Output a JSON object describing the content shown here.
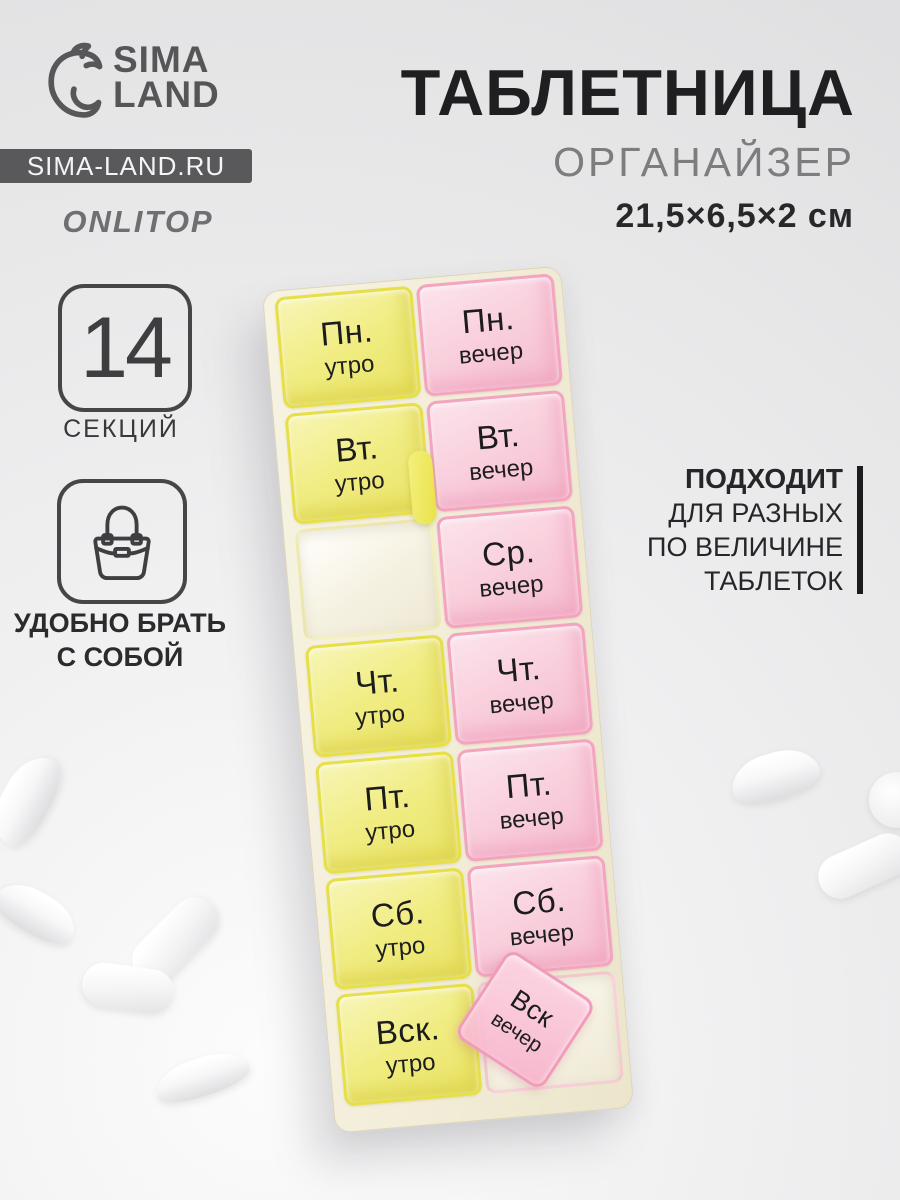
{
  "brand": {
    "logo_line1": "SIMA",
    "logo_line2": "LAND",
    "website": "SIMA-LAND.RU",
    "sub_brand": "ONLITOP"
  },
  "product": {
    "title": "ТАБЛЕТНИЦА",
    "subtitle": "ОРГАНАЙЗЕР",
    "dimensions": "21,5×6,5×2 см"
  },
  "features": {
    "sections": {
      "count": "14",
      "label": "СЕКЦИЙ"
    },
    "portable": {
      "line1": "УДОБНО БРАТЬ",
      "line2": "С СОБОЙ",
      "icon": "handbag-icon"
    },
    "fits": {
      "line1": "ПОДХОДИТ",
      "line2": "ДЛЯ РАЗНЫХ",
      "line3": "ПО ВЕЛИЧИНЕ",
      "line4": "ТАБЛЕТОК"
    }
  },
  "organizer": {
    "columns": [
      {
        "id": "morning",
        "accent": "#e7df48",
        "cells": [
          {
            "key": "mon",
            "day": "Пн.",
            "time": "утро",
            "state": "closed"
          },
          {
            "key": "tue",
            "day": "Вт.",
            "time": "утро",
            "state": "closed"
          },
          {
            "key": "wed",
            "day": "",
            "time": "",
            "state": "open-empty"
          },
          {
            "key": "thu",
            "day": "Чт.",
            "time": "утро",
            "state": "closed"
          },
          {
            "key": "fri",
            "day": "Пт.",
            "time": "утро",
            "state": "closed"
          },
          {
            "key": "sat",
            "day": "Сб.",
            "time": "утро",
            "state": "closed"
          },
          {
            "key": "sun",
            "day": "Вск.",
            "time": "утро",
            "state": "closed"
          }
        ]
      },
      {
        "id": "evening",
        "accent": "#f3a4bf",
        "cells": [
          {
            "key": "mon",
            "day": "Пн.",
            "time": "вечер",
            "state": "closed"
          },
          {
            "key": "tue",
            "day": "Вт.",
            "time": "вечер",
            "state": "closed"
          },
          {
            "key": "wed",
            "day": "Ср.",
            "time": "вечер",
            "state": "closed"
          },
          {
            "key": "thu",
            "day": "Чт.",
            "time": "вечер",
            "state": "closed"
          },
          {
            "key": "fri",
            "day": "Пт.",
            "time": "вечер",
            "state": "closed"
          },
          {
            "key": "sat",
            "day": "Сб.",
            "time": "вечер",
            "state": "closed"
          },
          {
            "key": "sun",
            "day": "Вск",
            "time": "вечер",
            "state": "open-lid"
          }
        ]
      }
    ]
  },
  "scene": {
    "pills": [
      {
        "shape": "tablet",
        "x": -22,
        "y": 776,
        "w": 96,
        "h": 48,
        "r": -62
      },
      {
        "shape": "tablet",
        "x": -8,
        "y": 892,
        "w": 88,
        "h": 42,
        "r": 30
      },
      {
        "shape": "capsule",
        "x": 124,
        "y": 917,
        "w": 102,
        "h": 46,
        "r": -45
      },
      {
        "shape": "capsule",
        "x": 82,
        "y": 966,
        "w": 92,
        "h": 44,
        "r": 8
      },
      {
        "shape": "tablet",
        "x": 154,
        "y": 1058,
        "w": 96,
        "h": 38,
        "r": -18
      },
      {
        "shape": "tablet",
        "x": 730,
        "y": 753,
        "w": 90,
        "h": 46,
        "r": -16
      },
      {
        "shape": "round",
        "x": 869,
        "y": 772,
        "w": 56,
        "h": 56,
        "r": 0
      },
      {
        "shape": "capsule",
        "x": 816,
        "y": 844,
        "w": 96,
        "h": 44,
        "r": -24
      }
    ]
  },
  "colors": {
    "ink": "#1f1f21",
    "gray_text": "#7d7d80",
    "band_bg": "#59595c",
    "yellow_accent": "#e7df48",
    "pink_accent": "#f3a4bf"
  }
}
